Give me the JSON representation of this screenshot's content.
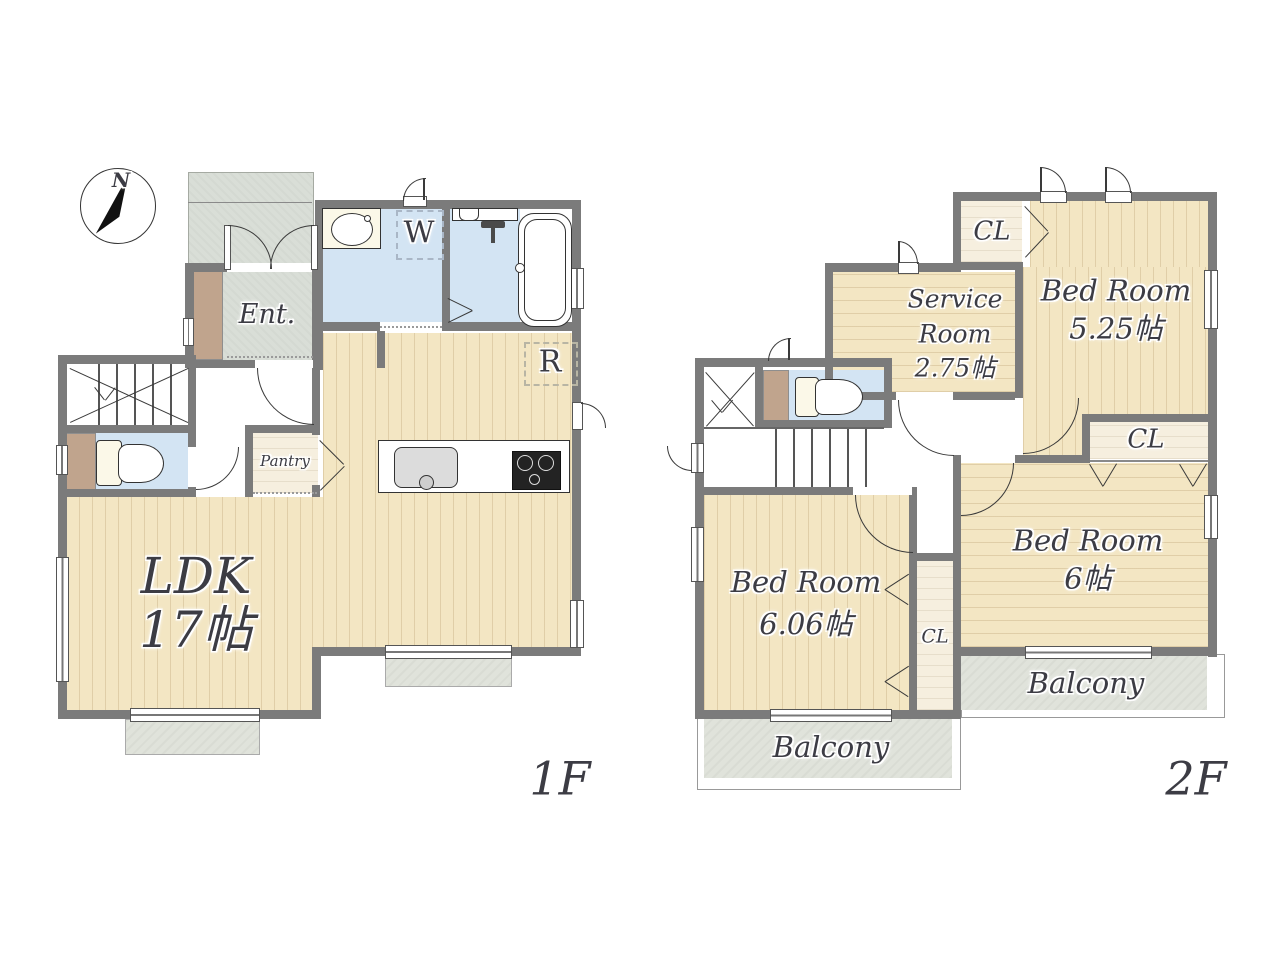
{
  "compass": {
    "north_label": "N"
  },
  "floor1": {
    "title": "1F",
    "entrance_label": "Ent.",
    "pantry_label": "Pantry",
    "ldk_label": "LDK",
    "ldk_size": "17帖",
    "washer_label": "W",
    "fridge_label": "R"
  },
  "floor2": {
    "title": "2F",
    "service_room": {
      "line1": "Service",
      "line2": "Room",
      "line3": "2.75帖"
    },
    "bedroom_525": {
      "label": "Bed Room",
      "size": "5.25帖"
    },
    "bedroom_6": {
      "label": "Bed Room",
      "size": "6帖"
    },
    "bedroom_606": {
      "label": "Bed Room",
      "size": "6.06帖"
    },
    "closet_top_label": "CL",
    "closet_right_label": "CL",
    "closet_mid_label": "CL",
    "balcony_left_label": "Balcony",
    "balcony_right_label": "Balcony"
  },
  "colors": {
    "wall": "#7b7b7b",
    "wood_floor": "#f3e6c3",
    "closet_floor": "#f6efdf",
    "wet_floor": "#d3e4f3",
    "entry_floor": "#d9ded7",
    "balcony_floor": "#e0e3db",
    "cabinet": "#c0a48d"
  }
}
